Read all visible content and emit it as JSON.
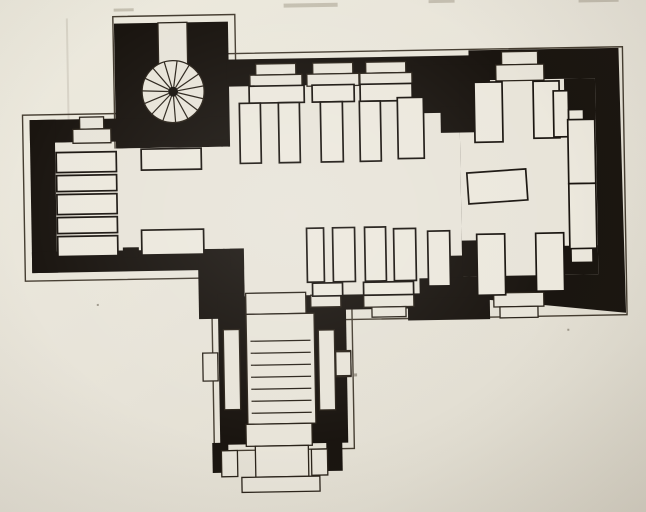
{
  "canvas": {
    "width": 646,
    "height": 512,
    "tilt_deg": -1,
    "tilt_cx": 323,
    "tilt_cy": 256
  },
  "colors": {
    "paper": "#e8e4d9",
    "ink": "#1a1510",
    "plinth_line": "#453d31",
    "furniture": "#ece8dd",
    "thin_line": "#2b241b"
  },
  "plan": {
    "layers": [
      {
        "name": "page-artifacts",
        "cls": "mark",
        "items": [
          {
            "x": 288,
            "y": 3,
            "w": 54,
            "h": 4,
            "n": "cropped-text-mark"
          },
          {
            "x": 433,
            "y": 2,
            "w": 26,
            "h": 3,
            "n": "cropped-text-mark"
          },
          {
            "x": 583,
            "y": 3,
            "w": 40,
            "h": 4,
            "n": "cropped-text-mark"
          },
          {
            "x": 118,
            "y": 5,
            "w": 20,
            "h": 3,
            "n": "cropped-text-mark"
          },
          {
            "x": 70,
            "y": 14,
            "w": 2,
            "h": 136,
            "c": "mark2",
            "n": "fold-line-mark"
          },
          {
            "x": 352,
            "y": 374,
            "w": 3,
            "h": 3,
            "c": "speck",
            "n": "paper-speck"
          },
          {
            "x": 420,
            "y": 183,
            "w": 2,
            "h": 2,
            "c": "speck",
            "n": "paper-speck"
          },
          {
            "x": 566,
            "y": 333,
            "w": 2,
            "h": 2,
            "c": "speck",
            "n": "paper-speck"
          },
          {
            "x": 96,
            "y": 300,
            "w": 2,
            "h": 2,
            "c": "speck",
            "n": "paper-speck"
          }
        ]
      },
      {
        "name": "plinth-outlines",
        "cls": "outline",
        "items": [
          {
            "x": 117,
            "y": 13,
            "w": 122,
            "h": 133,
            "n": "tower-plinth-outline"
          },
          {
            "x": 25,
            "y": 110,
            "w": 214,
            "h": 166,
            "n": "west-arm-plinth-outline"
          },
          {
            "x": 224,
            "y": 52,
            "w": 402,
            "h": 268,
            "n": "nave-chancel-plinth-outline"
          },
          {
            "x": 211,
            "y": 286,
            "w": 140,
            "h": 163,
            "n": "porch-plinth-outline"
          }
        ]
      },
      {
        "name": "wall-masses",
        "cls": "wall",
        "items": [
          {
            "x": 118,
            "y": 20,
            "w": 114,
            "h": 125,
            "n": "tower-wall"
          },
          {
            "x": 32,
            "y": 115,
            "w": 200,
            "h": 23,
            "n": "west-arm-north-wall"
          },
          {
            "x": 32,
            "y": 115,
            "w": 26,
            "h": 153,
            "n": "west-arm-west-wall"
          },
          {
            "x": 32,
            "y": 247,
            "w": 188,
            "h": 21,
            "n": "west-arm-south-wall"
          },
          {
            "x": 198,
            "y": 247,
            "w": 46,
            "h": 70,
            "n": "south-wall-turn"
          },
          {
            "t": "p",
            "pts": [
              [
                230,
                58
              ],
              [
                472,
                58
              ],
              [
                472,
                53
              ],
              [
                622,
                53
              ],
              [
                625,
                318
              ],
              [
                482,
                302
              ],
              [
                482,
                310
              ],
              [
                244,
                310
              ],
              [
                244,
                268
              ],
              [
                230,
                268
              ]
            ],
            "n": "nave-chancel-wall"
          },
          {
            "x": 217,
            "y": 292,
            "w": 128,
            "h": 151,
            "n": "porch-wall"
          },
          {
            "x": 209,
            "y": 441,
            "w": 16,
            "h": 30,
            "n": "porch-buttress"
          },
          {
            "x": 323,
            "y": 441,
            "w": 16,
            "h": 30,
            "n": "porch-buttress"
          }
        ]
      },
      {
        "name": "interior-floor",
        "cls": "paper",
        "items": [
          {
            "t": "p",
            "pts": [
              [
                57,
                138
              ],
              [
                113,
                138
              ],
              [
                113,
                145
              ],
              [
                232,
                145
              ],
              [
                232,
                85
              ],
              [
                462,
                85
              ],
              [
                462,
                295
              ],
              [
                305,
                295
              ],
              [
                305,
                313
              ],
              [
                245,
                313
              ],
              [
                245,
                295
              ],
              [
                244,
                295
              ],
              [
                244,
                247
              ],
              [
                57,
                247
              ]
            ],
            "n": "nave-floor"
          },
          {
            "x": 462,
            "y": 83,
            "w": 136,
            "h": 196,
            "n": "chancel-floor"
          }
        ]
      },
      {
        "name": "inner-wall-piers",
        "cls": "wall",
        "items": [
          {
            "x": 415,
            "y": 67,
            "w": 78,
            "h": 48,
            "n": "north-chancel-pier"
          },
          {
            "x": 443,
            "y": 109,
            "w": 50,
            "h": 26,
            "n": "north-chancel-pier-step"
          },
          {
            "x": 433,
            "y": 258,
            "w": 30,
            "h": 28,
            "n": "south-buttress-step"
          },
          {
            "x": 419,
            "y": 280,
            "w": 58,
            "h": 26,
            "n": "south-buttress-step"
          },
          {
            "x": 407,
            "y": 300,
            "w": 82,
            "h": 22,
            "n": "south-buttress-step"
          },
          {
            "x": 462,
            "y": 83,
            "w": 20,
            "h": 38,
            "n": "chancel-nw-corner"
          },
          {
            "x": 462,
            "y": 243,
            "w": 20,
            "h": 36,
            "n": "chancel-sw-corner"
          },
          {
            "x": 567,
            "y": 83,
            "w": 31,
            "h": 41,
            "n": "chancel-ne-corner"
          },
          {
            "x": 560,
            "y": 250,
            "w": 38,
            "h": 29,
            "n": "chancel-se-corner"
          },
          {
            "x": 123,
            "y": 244,
            "w": 16,
            "h": 10,
            "n": "crossing-wall-notch"
          }
        ]
      },
      {
        "name": "window-door-recesses",
        "cls": "open",
        "items": [
          {
            "x": 82,
            "y": 113,
            "w": 24,
            "h": 12,
            "n": "west-door-step"
          },
          {
            "x": 75,
            "y": 125,
            "w": 38,
            "h": 14,
            "n": "west-door-splay"
          },
          {
            "x": 259,
            "y": 63,
            "w": 40,
            "h": 11,
            "n": "window-recess"
          },
          {
            "x": 253,
            "y": 74,
            "w": 52,
            "h": 12,
            "n": "window-splay"
          },
          {
            "x": 316,
            "y": 63,
            "w": 40,
            "h": 11,
            "n": "window-recess"
          },
          {
            "x": 310,
            "y": 74,
            "w": 52,
            "h": 12,
            "n": "window-splay"
          },
          {
            "x": 369,
            "y": 63,
            "w": 40,
            "h": 11,
            "n": "window-recess"
          },
          {
            "x": 363,
            "y": 74,
            "w": 52,
            "h": 12,
            "n": "window-splay"
          },
          {
            "x": 505,
            "y": 55,
            "w": 36,
            "h": 13,
            "n": "chancel-north-window"
          },
          {
            "x": 499,
            "y": 68,
            "w": 48,
            "h": 16,
            "n": "chancel-north-window-splay"
          },
          {
            "x": 493,
            "y": 296,
            "w": 50,
            "h": 14,
            "n": "chancel-south-window-splay"
          },
          {
            "x": 499,
            "y": 310,
            "w": 38,
            "h": 11,
            "n": "chancel-south-window"
          },
          {
            "x": 363,
            "y": 295,
            "w": 50,
            "h": 13,
            "n": "nave-south-window-splay"
          },
          {
            "x": 371,
            "y": 308,
            "w": 34,
            "h": 10,
            "n": "nave-south-window"
          },
          {
            "x": 310,
            "y": 295,
            "w": 30,
            "h": 12,
            "n": "nave-south-window"
          },
          {
            "x": 201,
            "y": 351,
            "w": 15,
            "h": 28,
            "n": "porch-side-recess"
          },
          {
            "x": 334,
            "y": 351,
            "w": 15,
            "h": 26,
            "n": "porch-side-recess"
          }
        ]
      },
      {
        "name": "porch-stair",
        "cls": "open",
        "items": [
          {
            "x": 245,
            "y": 292,
            "w": 60,
            "h": 21,
            "n": "porch-door-landing"
          },
          {
            "x": 245,
            "y": 313,
            "w": 68,
            "h": 110,
            "n": "porch-staircase"
          },
          {
            "t": "l",
            "x1": 249,
            "y1": 340,
            "x2": 309,
            "y2": 340,
            "c": "sline",
            "n": "porch-stair-step"
          },
          {
            "t": "l",
            "x1": 249,
            "y1": 352,
            "x2": 309,
            "y2": 352,
            "c": "sline",
            "n": "porch-stair-step"
          },
          {
            "t": "l",
            "x1": 249,
            "y1": 364,
            "x2": 309,
            "y2": 364,
            "c": "sline",
            "n": "porch-stair-step"
          },
          {
            "t": "l",
            "x1": 249,
            "y1": 376,
            "x2": 309,
            "y2": 376,
            "c": "sline",
            "n": "porch-stair-step"
          },
          {
            "t": "l",
            "x1": 249,
            "y1": 388,
            "x2": 309,
            "y2": 388,
            "c": "sline",
            "n": "porch-stair-step"
          },
          {
            "t": "l",
            "x1": 249,
            "y1": 400,
            "x2": 309,
            "y2": 400,
            "c": "sline",
            "n": "porch-stair-step"
          },
          {
            "t": "l",
            "x1": 249,
            "y1": 412,
            "x2": 309,
            "y2": 412,
            "c": "sline",
            "n": "porch-stair-step"
          },
          {
            "x": 222,
            "y": 328,
            "w": 16,
            "h": 80,
            "n": "porch-side-bench"
          },
          {
            "x": 317,
            "y": 330,
            "w": 16,
            "h": 80,
            "n": "porch-side-bench"
          },
          {
            "x": 334,
            "y": 352,
            "w": 15,
            "h": 24,
            "n": "porch-side-recess"
          },
          {
            "x": 243,
            "y": 423,
            "w": 66,
            "h": 22,
            "n": "porch-threshold"
          },
          {
            "x": 252,
            "y": 445,
            "w": 53,
            "h": 31,
            "n": "entrance-platform-step"
          },
          {
            "x": 238,
            "y": 476,
            "w": 78,
            "h": 15,
            "n": "entrance-platform-base"
          },
          {
            "x": 218,
            "y": 449,
            "w": 16,
            "h": 26,
            "n": "entrance-flank-block"
          },
          {
            "x": 308,
            "y": 449,
            "w": 16,
            "h": 26,
            "n": "entrance-flank-block"
          }
        ]
      },
      {
        "name": "pews-and-furniture",
        "cls": "furn",
        "items": [
          {
            "x": 58,
            "y": 148,
            "w": 60,
            "h": 20,
            "n": "west-bench-row"
          },
          {
            "x": 58,
            "y": 171,
            "w": 60,
            "h": 16,
            "n": "west-bench-row"
          },
          {
            "x": 58,
            "y": 190,
            "w": 60,
            "h": 20,
            "n": "west-bench-row"
          },
          {
            "x": 58,
            "y": 213,
            "w": 60,
            "h": 16,
            "n": "west-bench-row"
          },
          {
            "x": 58,
            "y": 232,
            "w": 60,
            "h": 20,
            "n": "west-bench-row"
          },
          {
            "x": 143,
            "y": 146,
            "w": 60,
            "h": 21,
            "n": "crossing-pew"
          },
          {
            "x": 142,
            "y": 227,
            "w": 62,
            "h": 25,
            "n": "crossing-pew"
          },
          {
            "x": 252,
            "y": 85,
            "w": 55,
            "h": 17,
            "n": "north-pew-back"
          },
          {
            "x": 315,
            "y": 85,
            "w": 42,
            "h": 17,
            "n": "north-pew-back"
          },
          {
            "x": 363,
            "y": 85,
            "w": 52,
            "h": 17,
            "n": "north-pew-back"
          },
          {
            "x": 242,
            "y": 102,
            "w": 21,
            "h": 60,
            "n": "box-pew"
          },
          {
            "x": 281,
            "y": 102,
            "w": 21,
            "h": 60,
            "n": "box-pew"
          },
          {
            "x": 323,
            "y": 102,
            "w": 22,
            "h": 60,
            "n": "box-pew"
          },
          {
            "x": 362,
            "y": 102,
            "w": 21,
            "h": 60,
            "n": "box-pew"
          },
          {
            "x": 400,
            "y": 99,
            "w": 26,
            "h": 61,
            "n": "box-pew"
          },
          {
            "x": 307,
            "y": 228,
            "w": 17,
            "h": 54,
            "n": "box-pew"
          },
          {
            "x": 333,
            "y": 228,
            "w": 22,
            "h": 54,
            "n": "box-pew"
          },
          {
            "x": 365,
            "y": 228,
            "w": 21,
            "h": 54,
            "n": "box-pew"
          },
          {
            "x": 394,
            "y": 230,
            "w": 22,
            "h": 52,
            "n": "box-pew"
          },
          {
            "x": 428,
            "y": 233,
            "w": 22,
            "h": 55,
            "n": "box-pew"
          },
          {
            "x": 312,
            "y": 283,
            "w": 30,
            "h": 13,
            "n": "south-pew-back"
          },
          {
            "x": 363,
            "y": 283,
            "w": 50,
            "h": 13,
            "n": "south-pew-back"
          },
          {
            "x": 477,
            "y": 85,
            "w": 28,
            "h": 60,
            "n": "chancel-pew"
          },
          {
            "x": 536,
            "y": 85,
            "w": 26,
            "h": 57,
            "n": "chancel-pew"
          },
          {
            "x": 477,
            "y": 237,
            "w": 28,
            "h": 61,
            "n": "chancel-pew"
          },
          {
            "x": 536,
            "y": 237,
            "w": 28,
            "h": 58,
            "n": "chancel-pew"
          },
          {
            "x": 556,
            "y": 95,
            "w": 15,
            "h": 46,
            "n": "chancel-corner-seat"
          },
          {
            "x": 571,
            "y": 114,
            "w": 15,
            "h": 27,
            "n": "chancel-corner-seat"
          },
          {
            "x": 571,
            "y": 250,
            "w": 22,
            "h": 17,
            "n": "chancel-corner-seat"
          },
          {
            "x": 570,
            "y": 124,
            "w": 27,
            "h": 64,
            "n": "east-wall-bench"
          },
          {
            "x": 570,
            "y": 188,
            "w": 27,
            "h": 65,
            "n": "east-wall-bench"
          },
          {
            "x": 469,
            "y": 174,
            "w": 59,
            "h": 31,
            "rot": -3,
            "n": "communion-table"
          }
        ]
      },
      {
        "name": "spiral-staircase",
        "cls": "open",
        "spiral": {
          "cx": 176,
          "cy": 89,
          "r": 31,
          "spokes": 15,
          "hub_r": 5
        },
        "items": [
          {
            "x": 162,
            "y": 20,
            "w": 29,
            "h": 52,
            "n": "stair-turret-shaft"
          }
        ]
      }
    ]
  }
}
